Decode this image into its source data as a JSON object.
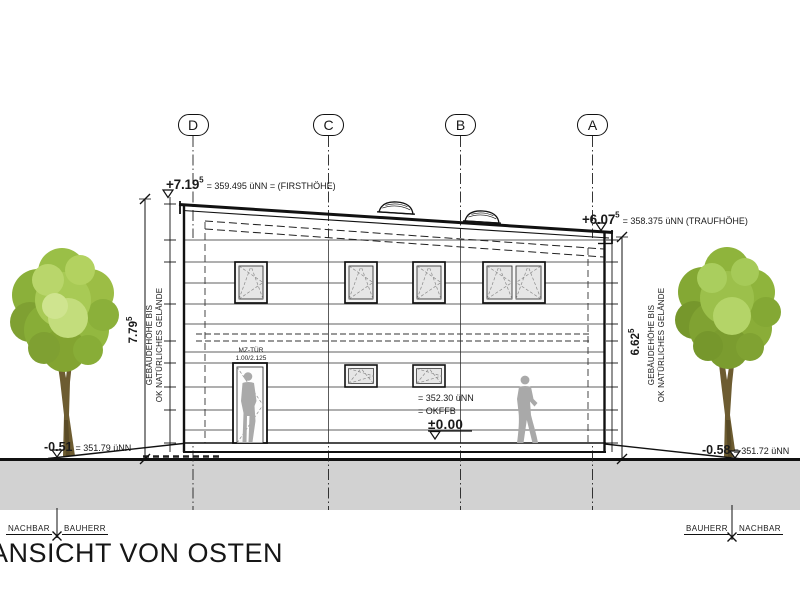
{
  "title": "ANSICHT VON OSTEN",
  "axes": [
    {
      "label": "D"
    },
    {
      "label": "C"
    },
    {
      "label": "B"
    },
    {
      "label": "A"
    }
  ],
  "levels": {
    "first": {
      "value": "+7.19",
      "sup": "5",
      "note": "= 359.495 üNN = (FIRSTHÖHE)"
    },
    "trauf": {
      "value": "+6.07",
      "sup": "5",
      "note": "= 358.375 üNN (TRAUFHÖHE)"
    },
    "ground_left": {
      "value": "-0.51",
      "note": "= 351.79 üNN"
    },
    "ground_right": {
      "value": "-0.58",
      "note": "= 351.72 üNN"
    },
    "ffb": {
      "line1": "= 352.30 üNN",
      "line2": "= OKFFB",
      "line3": "±0.00"
    }
  },
  "dimensions": {
    "left": {
      "value": "7.79",
      "sup": "5",
      "label_line1": "GEBÄUDEHÖHE BIS",
      "label_line2": "OK NATÜRLICHES GELÄNDE"
    },
    "right": {
      "value": "6.62",
      "sup": "5",
      "label_line1": "GEBÄUDEHÖHE BIS",
      "label_line2": "OK NATÜRLICHES GELÄNDE"
    }
  },
  "door": {
    "label_line1": "MZ-TÜR",
    "label_line2": "1.00/2.125"
  },
  "site_labels": {
    "left": {
      "first": "NACHBAR",
      "second": "BAUHERR"
    },
    "right": {
      "first": "BAUHERR",
      "second": "NACHBAR"
    }
  },
  "colors": {
    "line": "#1a1a1a",
    "ground_fill": "#d2d2d2",
    "figure_gray": "#a9a9a9",
    "glass": "#e6e6e6",
    "foliage_light": "#b9d66b",
    "foliage_mid": "#9abf47",
    "foliage_dark": "#7fa032",
    "trunk": "#6d5c31"
  }
}
